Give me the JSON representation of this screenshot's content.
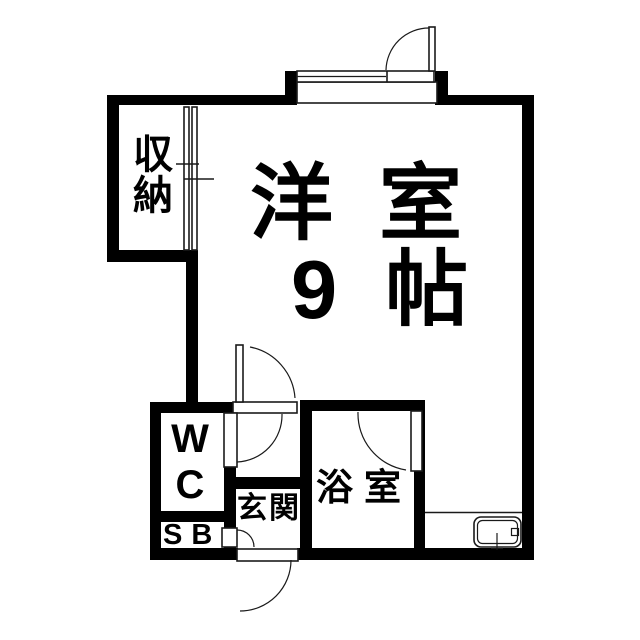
{
  "title": "apartment-floor-plan",
  "rooms": {
    "main": {
      "name": "洋室",
      "size": "9帖"
    },
    "closet": {
      "label_lines": [
        "収",
        "納"
      ]
    },
    "wc": {
      "label_lines": [
        "W",
        "C"
      ]
    },
    "shoe_box": {
      "label": "SB"
    },
    "entrance": {
      "label": "玄関"
    },
    "bathroom": {
      "label": "浴室"
    }
  },
  "colors": {
    "wall": "#000000",
    "background": "#ffffff",
    "line": "#1a1a1a"
  }
}
